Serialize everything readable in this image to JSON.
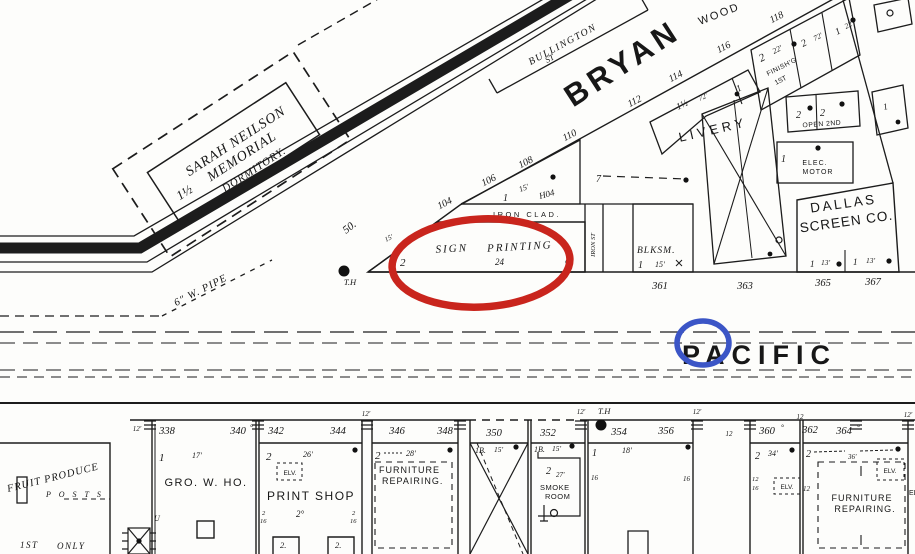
{
  "colors": {
    "red_circle": "#c9251d",
    "blue_circle": "#3b55c6",
    "ink": "#1c1c1c"
  },
  "streets": {
    "bryan": "BRYAN",
    "pacific": "PACIFIC",
    "wood": "WOOD",
    "bullington": "BULLINGTON",
    "bullington_st": "ST",
    "iron_st": "IRON ST"
  },
  "north": {
    "dorm_stories": "1½",
    "dorm_name1": "SARAH NEILSON",
    "dorm_name2": "MEMORIAL",
    "dorm_name3": "DORMITORY.",
    "fifty": "50.",
    "pipe": "6\" W. PIPE",
    "th": "T.H",
    "addresses": [
      "104",
      "106",
      "108",
      "110",
      "112",
      "114",
      "116",
      "118"
    ],
    "lots": [
      "361",
      "363",
      "365",
      "367"
    ],
    "triangle_stories": "1",
    "triangle_width": "15'",
    "triangle_num": "H04",
    "iron_clad": "IRON CLAD.",
    "sign_stories": "2",
    "sign_width": "15'",
    "sign_name1": "SIGN",
    "sign_name2": "PRINTING",
    "sign_height": "24",
    "blksm_name": "BLKSM.",
    "blksm_stories": "1",
    "blksm_width": "15'",
    "blksm_corner": "7",
    "livery_name": "LIVERY",
    "livery_s1": "1½",
    "livery_w1": "72'",
    "livery_s2": "1",
    "fin_s1": "2",
    "fin_w1": "22'",
    "fin_name1": "FINISH'G",
    "fin_name2": "1ST",
    "fin_s2": "2",
    "fin_w2": "72'",
    "fin_s3": "1",
    "fin_w3": "22'",
    "open_s1": "2",
    "open_s2": "2",
    "open_label": "OPEN 2ND",
    "elec_stories": "1",
    "elec_name1": "ELEC.",
    "elec_name2": "MOTOR",
    "dallas_name1": "DALLAS",
    "dallas_name2": "SCREEN CO.",
    "dallas_c1s": "1",
    "dallas_c1w": "13'",
    "dallas_c2s": "1",
    "dallas_c2w": "13'",
    "tr_stories": "1"
  },
  "south": {
    "th": "T.H",
    "addresses": [
      "338",
      "340",
      "342",
      "344",
      "346",
      "348",
      "350",
      "352",
      "354",
      "356",
      "360",
      "362",
      "364"
    ],
    "tick_12": "12'",
    "tick_12plain": "12",
    "deg": "°",
    "fruit_name": "FRUIT PRODUCE",
    "fruit_posts": "P O S T S",
    "fruit_only1": "1ST",
    "fruit_only2": "ONLY",
    "gro_stories": "1",
    "gro_width": "17'",
    "gro_name": "GRO. W. HO.",
    "gro_door": "U",
    "print_stories": "2",
    "print_width": "26'",
    "print_elv": "ELV.",
    "print_name": "PRINT SHOP",
    "print_floor": "2°",
    "print_h1a": "2",
    "print_h1b": "16",
    "print_h2a": "2",
    "print_h2b": "16",
    "print_shed1": "2.",
    "print_shed2": "2.",
    "furn1_stories": "2",
    "furn1_width": "28'",
    "furn1_name1": "FURNITURE",
    "furn1_name2": "REPAIRING.",
    "x_mark_s": "1B.",
    "x_mark_w": "15'",
    "smoke_mark_s": "1B.",
    "smoke_mark_w": "15'",
    "smoke_s": "2",
    "smoke_w": "27'",
    "smoke_name1": "SMOKE",
    "smoke_name2": "ROOM",
    "b354_s": "1",
    "b354_w": "18'",
    "b354_h1": "16",
    "b354_h2": "16",
    "gap_12": "12",
    "b360_s": "2",
    "b360_w": "34'",
    "b360_h1": "12",
    "b360_h2": "16",
    "b360_elv": "ELV.",
    "b360_12": "12",
    "furn2_s": "2",
    "furn2_w": "36'",
    "furn2_name1": "FURNITURE",
    "furn2_name2": "REPAIRING.",
    "furn2_elv": "ELV.",
    "furn2_edge": "EL"
  }
}
